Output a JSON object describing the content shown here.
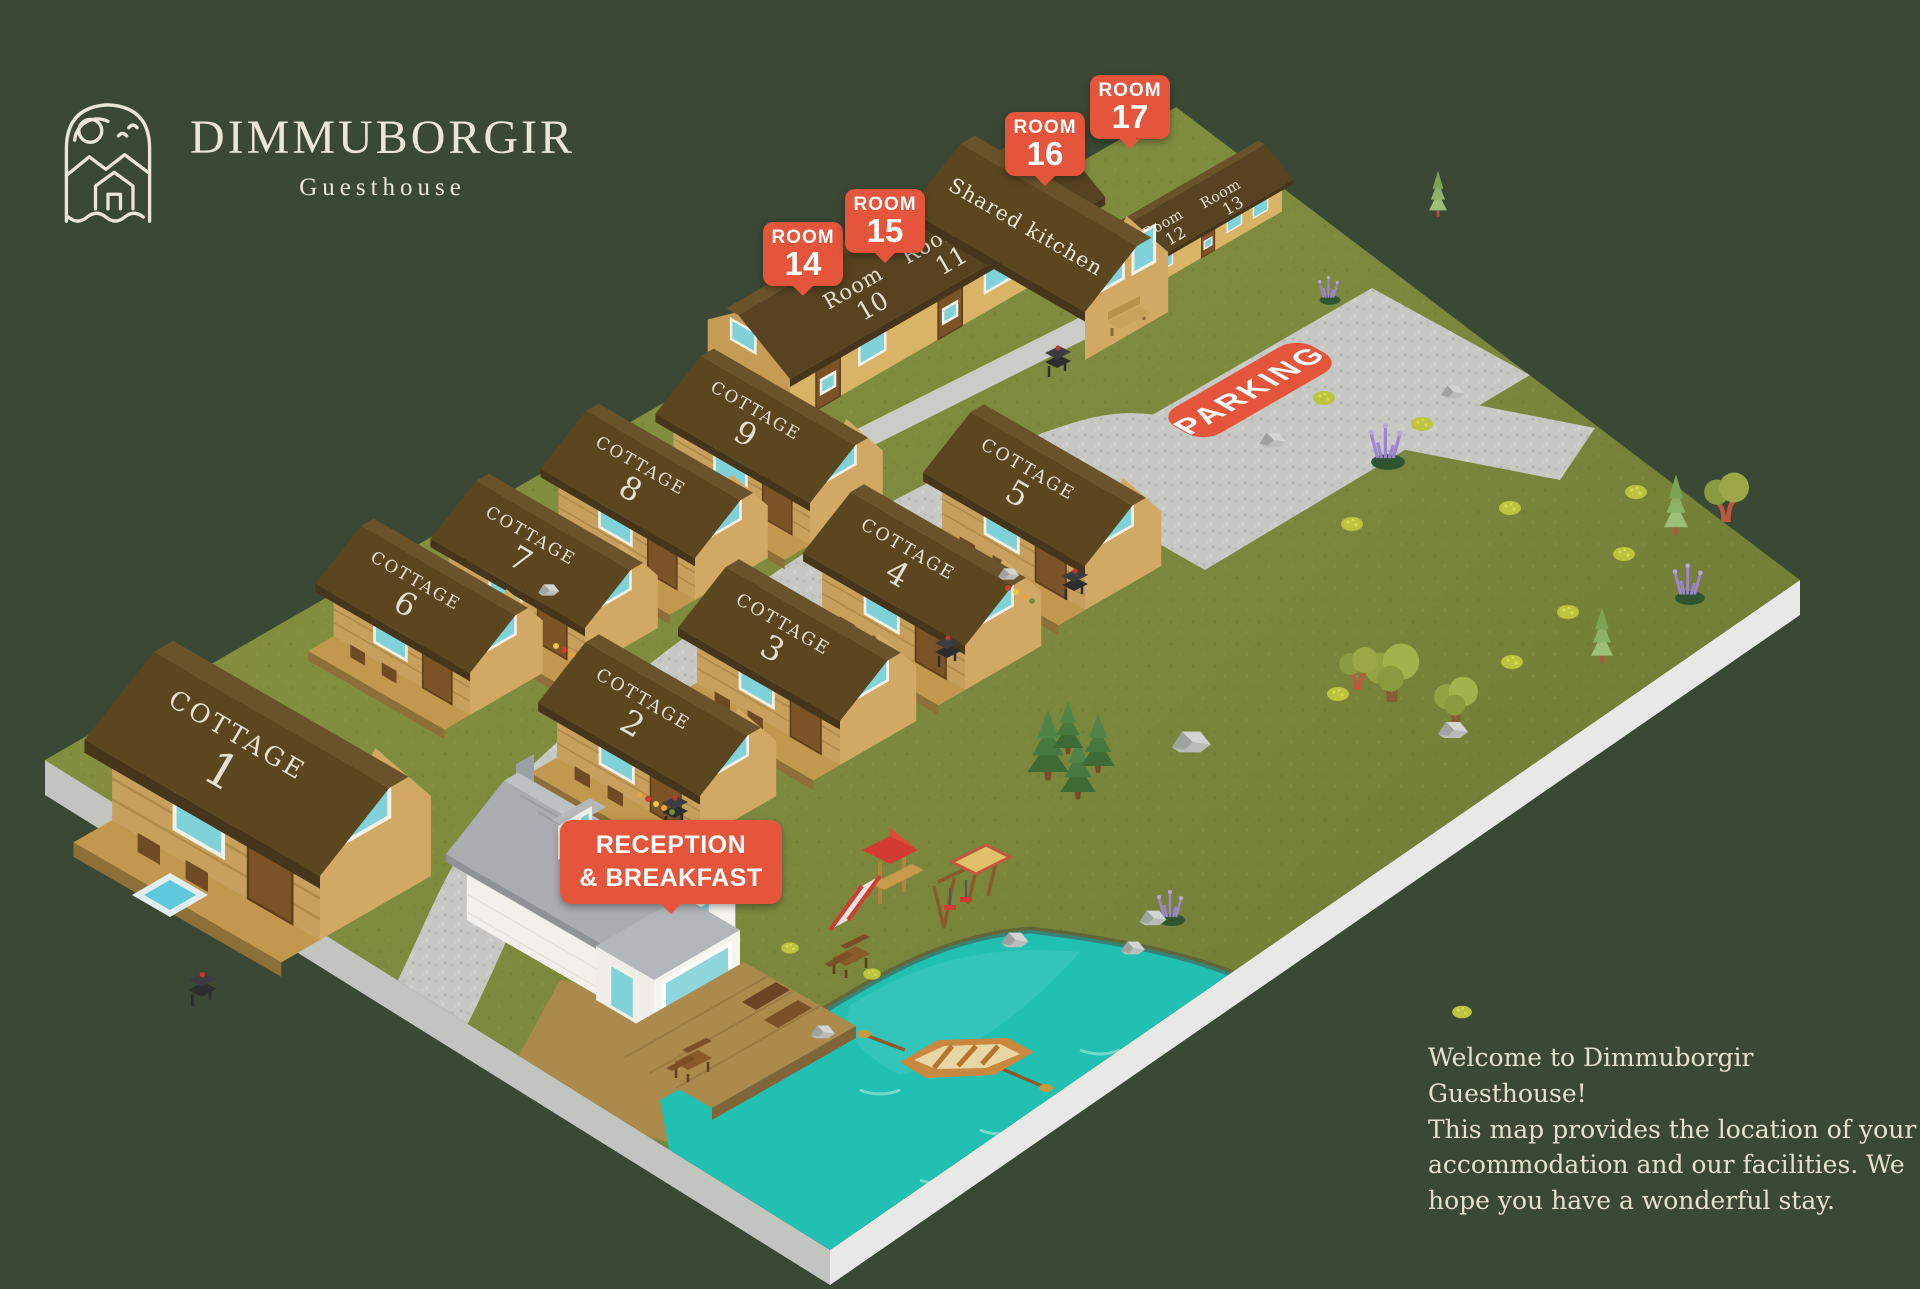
{
  "logo": {
    "title": "DIMMUBORGIR",
    "subtitle": "Guesthouse"
  },
  "map": {
    "cottages": [
      {
        "label": "COTTAGE",
        "num": "1"
      },
      {
        "label": "COTTAGE",
        "num": "2"
      },
      {
        "label": "COTTAGE",
        "num": "3"
      },
      {
        "label": "COTTAGE",
        "num": "4"
      },
      {
        "label": "COTTAGE",
        "num": "5"
      },
      {
        "label": "COTTAGE",
        "num": "6"
      },
      {
        "label": "COTTAGE",
        "num": "7"
      },
      {
        "label": "COTTAGE",
        "num": "8"
      },
      {
        "label": "COTTAGE",
        "num": "9"
      }
    ],
    "rooms": [
      {
        "label": "Room",
        "num": "10"
      },
      {
        "label": "Room",
        "num": "11"
      },
      {
        "label": "Room",
        "num": "12"
      },
      {
        "label": "Room",
        "num": "13"
      }
    ],
    "kitchen_label": "Shared kitchen",
    "pins": [
      {
        "label": "ROOM",
        "num": "14"
      },
      {
        "label": "ROOM",
        "num": "15"
      },
      {
        "label": "ROOM",
        "num": "16"
      },
      {
        "label": "ROOM",
        "num": "17"
      }
    ],
    "parking_label": "PARKING",
    "reception_pin": {
      "line1": "RECEPTION",
      "line2": "& BREAKFAST"
    }
  },
  "welcome_text": "Welcome to Dimmuborgir Guesthouse!\nThis map provides the location of your\naccommodation and our facilities. We\nhope you have a wonderful stay.",
  "colors": {
    "background": "#3c4836",
    "accent_orange": "#e4553b",
    "roof_brown": "#5b4620",
    "cottage_wood": "#c7a05e",
    "lodge_wall": "#d9b466",
    "grass_green": "#7d8a3e",
    "road_gray": "#c7c8c4",
    "lake_teal": "#22bfb3",
    "cream": "#ece6d6",
    "window_teal": "#7fd2d8",
    "reception_white": "#f2f0ea",
    "roof_gray": "#a9adb0"
  }
}
